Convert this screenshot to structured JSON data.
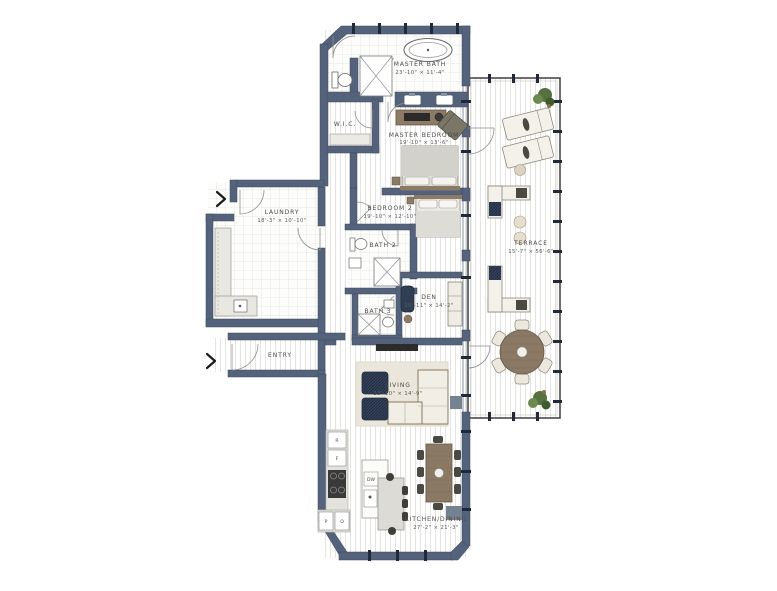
{
  "plan": {
    "type": "residential-floor-plan",
    "rooms": {
      "master_bath": {
        "name": "MASTER BATH",
        "dims": "23'-10\" × 11'-4\""
      },
      "wic": {
        "name": "W.I.C."
      },
      "master_bedroom": {
        "name": "MASTER BEDROOM",
        "dims": "19'-10\" × 13'-6\""
      },
      "bedroom2": {
        "name": "BEDROOM 2",
        "dims": "19'-10\" × 12'-10\""
      },
      "bath2": {
        "name": "BATH 2"
      },
      "bath3": {
        "name": "BATH 3"
      },
      "den": {
        "name": "DEN",
        "dims": "10'-11\" × 14'-2\""
      },
      "laundry": {
        "name": "LAUNDRY",
        "dims": "18'-3\" × 10'-10\""
      },
      "entry": {
        "name": "ENTRY"
      },
      "living": {
        "name": "LIVING",
        "dims": "23'-10\" × 14'-9\""
      },
      "kitchen_dining": {
        "name": "KITCHEN/DINING",
        "dims": "27'-2\" × 21'-3\""
      },
      "terrace": {
        "name": "TERRACE",
        "dims": "15'-7\" × 56'-6\""
      }
    },
    "appliances": {
      "r": "R",
      "f": "F",
      "dw": "DW",
      "p": "P",
      "o": "O"
    },
    "icons": {
      "entry_arrow": "chevron-right"
    },
    "colors": {
      "wall": "#54637b",
      "floor_line": "#e6e4e0",
      "furniture_beige": "#f1eee6",
      "wood_brown": "#8a7964",
      "dark_upholstery": "#33415a",
      "plant_green": "#55713f",
      "accent_gray": "#75828f"
    }
  }
}
